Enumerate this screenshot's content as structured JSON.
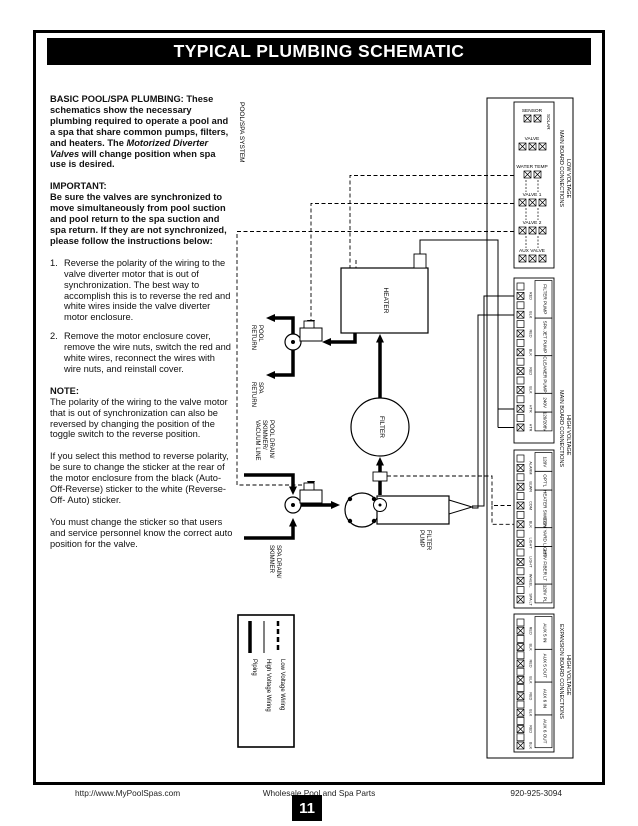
{
  "title": "TYPICAL PLUMBING SCHEMATIC",
  "left_column": {
    "p1_heading": "BASIC POOL/SPA PLUMBING:",
    "p1_body_1": "These schematics show the necessary plumbing required to operate a pool and a spa that share common pumps, filters, and heaters.  The",
    "p1_italic": "Motorized Diverter Valves",
    "p1_body_2": "will change position when spa use is desired.",
    "p2_heading": "IMPORTANT:",
    "p2_body": "Be sure the valves are synchronized to move simultaneously from pool suction and pool return to the spa suction and spa return. If they are not synchronized, please follow the instructions below:",
    "list": [
      {
        "num": "1.",
        "text": "Reverse the polarity of the wiring to the valve diverter motor that is out of synchronization. The best way to accomplish this is to reverse the red and white wires inside the valve diverter motor enclosure."
      },
      {
        "num": "2.",
        "text": "Remove the motor enclosure cover, remove the wire nuts, switch the red and white wires, reconnect the wires with wire nuts, and reinstall cover."
      }
    ],
    "note_heading": "NOTE:",
    "note_body": "The polarity of the wiring to the valve motor that is out of synchronization can also be reversed by changing the position of the toggle switch to the reverse position.",
    "p5": "If you select this method to reverse polarity, be sure to change the sticker at the rear of the motor enclosure from the black (Auto-Off-Reverse) sticker to the white (Reverse- Off- Auto) sticker.",
    "p6": "You must change the sticker so that users and service personnel know the correct auto position for the valve."
  },
  "diagram": {
    "system_label": "POOL/SPA SYSTEM",
    "heater": "HEATER",
    "filter": "FILTER",
    "filter_pump": [
      "FILTER",
      "PUMP"
    ],
    "pool_return": [
      "POOL",
      "RETURN"
    ],
    "spa_return": [
      "SPA",
      "RETURN"
    ],
    "pool_drain": [
      "POOL DRAIN/",
      "SKIMMER/",
      "VACUUM LINE"
    ],
    "spa_drain": [
      "SPA DRAIN/",
      "SKIMMER"
    ],
    "legend": [
      {
        "style": "thick",
        "label": "Piping"
      },
      {
        "style": "thin",
        "label": "High Voltage Wiring"
      },
      {
        "style": "dashed",
        "label": "Low Voltage Wiring"
      }
    ]
  },
  "panel": {
    "low_voltage": {
      "header_line1": "LOW VOLTAGE",
      "header_line2": "MAIN BOARD CONNECTIONS",
      "solar_label": "SOLAR",
      "rows": [
        {
          "label": "SENSOR",
          "terminals": 2
        },
        {
          "label": "VALVE",
          "terminals": 3
        },
        {
          "label": "WATER TEMP",
          "terminals": 2
        },
        {
          "label": "VALVE 1",
          "terminals": 3
        },
        {
          "label": "VALVE 2",
          "terminals": 3
        },
        {
          "label": "AUX VALVE",
          "terminals": 3
        }
      ]
    },
    "high_voltage_main": {
      "header_line1": "HIGH VOLTAGE",
      "header_line2": "MAIN BOARD CONNECTIONS",
      "groups_upper": [
        {
          "label": "FILTER PUMP",
          "wires": [
            "RED",
            "BLK"
          ]
        },
        {
          "label": "SPA JET PUMP",
          "wires": [
            "RED",
            "BLK"
          ]
        },
        {
          "label": "CLEANER PUMP",
          "wires": [
            "RED",
            "BLK"
          ]
        },
        {
          "label": "240V",
          "wires": [
            "HTR"
          ]
        },
        {
          "label": "120/208V",
          "wires": [
            "HTR"
          ]
        }
      ],
      "groups_lower": [
        {
          "label": "120V",
          "wires": [
            "ALARM"
          ]
        },
        {
          "label": "OPT'L",
          "wires": [
            "BLWR"
          ]
        },
        {
          "label": "HEATER SWITCH",
          "wires": [
            "COM",
            "BLK"
          ]
        },
        {
          "label": "120V YARD LIGHT",
          "wires": [
            "LIGHT"
          ]
        },
        {
          "label": "120V FIBER LT",
          "wires": [
            "LIGHT",
            "WHEEL"
          ]
        },
        {
          "label": "120V PL",
          "wires": [
            "SPA LT"
          ]
        }
      ]
    },
    "expansion": {
      "header_line1": "HIGH VOLTAGE",
      "header_line2": "EXPANSION BOARD CONNECTIONS",
      "groups": [
        {
          "label": "AUX 5 IN",
          "wires": [
            "RED",
            "BLK"
          ]
        },
        {
          "label": "AUX 5 OUT",
          "wires": [
            "RED",
            "BLK"
          ]
        },
        {
          "label": "AUX 6 IN",
          "wires": [
            "RED",
            "BLK"
          ]
        },
        {
          "label": "AUX 6 OUT",
          "wires": [
            "RED",
            "BLK"
          ]
        }
      ]
    }
  },
  "footer": {
    "left": "http://www.MyPoolSpas.com",
    "center": "Wholesale Pool and Spa Parts",
    "right": "920-925-3094",
    "page_number": "11"
  }
}
